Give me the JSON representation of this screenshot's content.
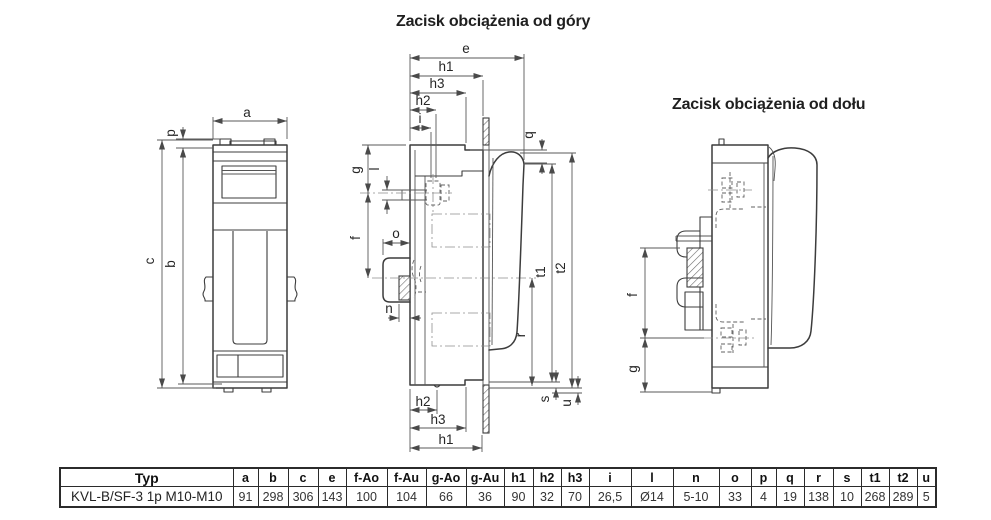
{
  "titles": {
    "top_terminal": "Zacisk obciążenia od góry",
    "bottom_terminal": "Zacisk obciążenia od dołu"
  },
  "dim_labels": {
    "a": "a",
    "b": "b",
    "c": "c",
    "p": "p",
    "e": "e",
    "h1": "h1",
    "h2": "h2",
    "h3": "h3",
    "i": "i",
    "q": "q",
    "g": "g",
    "l": "l",
    "f": "f",
    "o": "o",
    "n": "n",
    "t1": "t1",
    "t2": "t2",
    "r": "r",
    "s": "s",
    "u": "u"
  },
  "table": {
    "headers": [
      "Typ",
      "a",
      "b",
      "c",
      "e",
      "f-Ao",
      "f-Au",
      "g-Ao",
      "g-Au",
      "h1",
      "h2",
      "h3",
      "i",
      "l",
      "n",
      "o",
      "p",
      "q",
      "r",
      "s",
      "t1",
      "t2",
      "u"
    ],
    "rows": [
      [
        "KVL-B/SF-3 1p M10-M10",
        "91",
        "298",
        "306",
        "143",
        "100",
        "104",
        "66",
        "36",
        "90",
        "32",
        "70",
        "26,5",
        "Ø14",
        "5-10",
        "33",
        "4",
        "19",
        "138",
        "10",
        "268",
        "289",
        "5"
      ]
    ]
  },
  "colors": {
    "line": "#3c3c3c",
    "dim": "#5a5a5a",
    "text": "#262626"
  }
}
